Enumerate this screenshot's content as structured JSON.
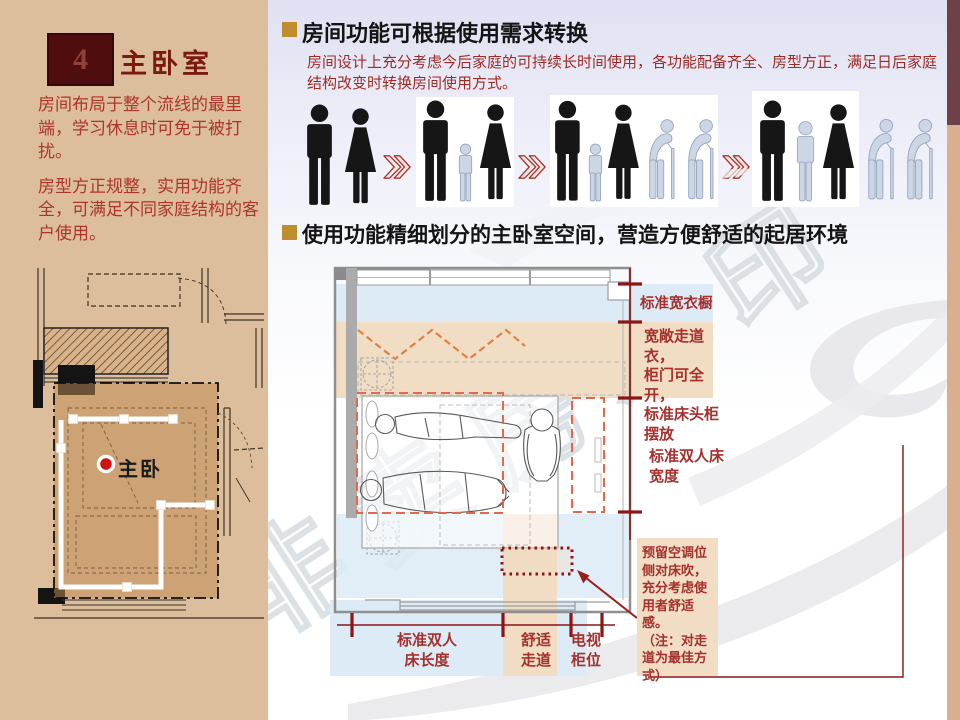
{
  "slide": {
    "watermark": "非卖房水印"
  },
  "sidebar": {
    "number": "4",
    "title": "主卧室",
    "paragraphs": [
      "房间布局于整个流线的最里端，学习休息时可免于被打扰。",
      "房型方正规整，实用功能齐全，可满足不同家庭结构的客户使用。"
    ],
    "floor_plan": {
      "room_label": "主卧"
    }
  },
  "section_transform": {
    "heading": "房间功能可根据使用需求转换",
    "body": "房间设计上充分考虑今后家庭的可持续长时间使用，各功能配备齐全、房型方正，满足日后家庭结构改变时转换房间使用方式。",
    "arrow_symbol": "≫",
    "stages": [
      {
        "icons": [
          "man-icon",
          "woman-icon"
        ]
      },
      {
        "icons": [
          "man-icon",
          "child-icon",
          "woman-icon"
        ]
      },
      {
        "icons": [
          "man-icon",
          "child-icon",
          "woman-icon",
          "elder-icon",
          "elder-icon"
        ]
      },
      {
        "icons": [
          "man-icon",
          "teen-icon",
          "woman-icon",
          "elder-icon",
          "elder-icon"
        ]
      }
    ]
  },
  "section_layout": {
    "heading": "使用功能精细划分的主卧室空间，营造方便舒适的起居环境",
    "right_labels": {
      "wardrobe": "标准宽衣橱",
      "closet": "宽敞走道衣，\n柜门可全开，\n标准床头柜\n摆放",
      "bed_width": "标准双人床\n宽度"
    },
    "ac_note": "预留空调位\n侧对床吹，\n充分考虑使\n用者舒适感。\n（注：对走\n道为最佳方\n式）",
    "bottom_labels": {
      "bed_length": "标准双人\n床长度",
      "walkway": "舒适\n走道",
      "tv_cabinet": "电视\n柜位"
    }
  },
  "colors": {
    "sidebar_bg": "#dcbd9c",
    "accent_dark_red": "#8b1515",
    "text_red": "#a5302c",
    "heading_bullet": "#bd8d2e",
    "band_blue": "#dcebf6",
    "band_tan": "#f1ddc4",
    "number_box": "#4f0d0d",
    "strip_maroon": "#6e4048",
    "strip_tan": "#d9af8d"
  }
}
